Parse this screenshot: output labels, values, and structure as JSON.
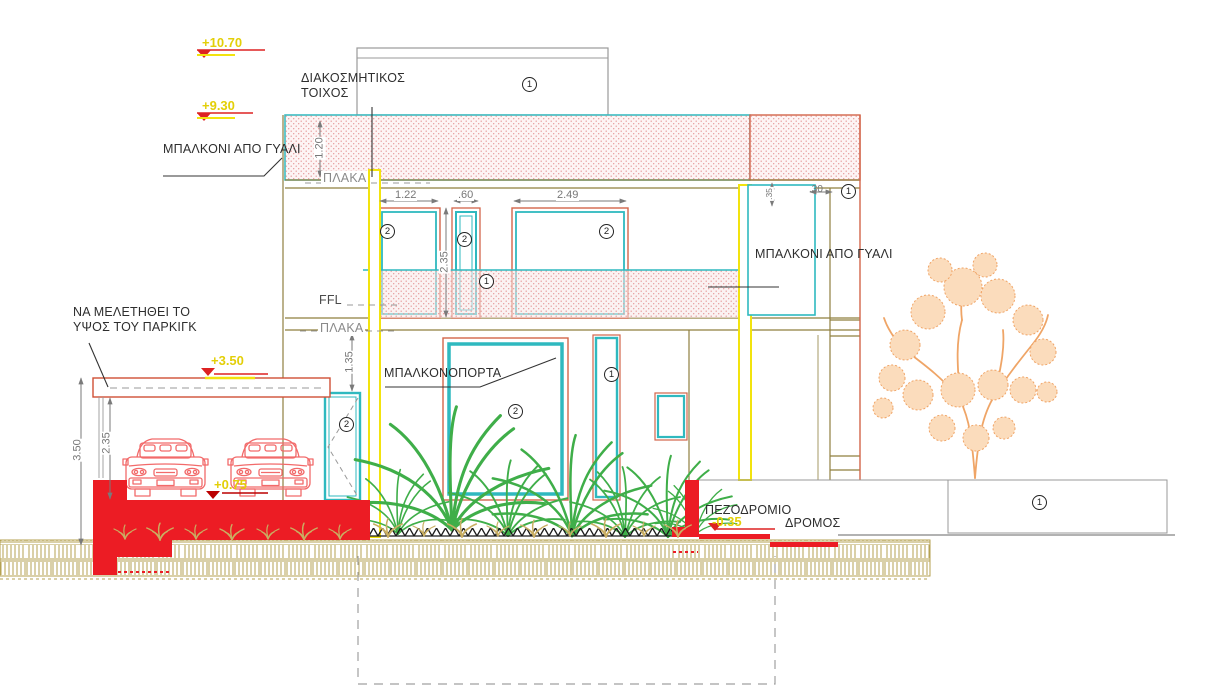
{
  "drawing": {
    "type": "building-front-elevation",
    "labels": {
      "decorative_wall": "ΔΙΑΚΟΣΜΗΤΙΚΟΣ\nΤΟΙΧΟΣ",
      "balcony_glass_left": "ΜΠΑΛΚΟΝΙ ΑΠΟ ΓΥΑΛΙ",
      "balcony_glass_right": "ΜΠΑΛΚΟΝΙ ΑΠΟ ΓΥΑΛΙ",
      "slab_upper": "ΠΛΑΚΑ",
      "ffl": "FFL",
      "slab_lower": "ΠΛΑΚΑ",
      "parking_note": "ΝΑ ΜΕΛΕΤΗΘΕΙ ΤΟ\nΥΨΟΣ ΤΟΥ ΠΑΡΚΙΓΚ",
      "balcony_door": "ΜΠΑΛΚΟΝΟΠΟΡΤΑ",
      "sidewalk": "ΠΕΖΟΔΡΟΜΙΟ",
      "road": "ΔΡΟΜΟΣ"
    },
    "elevation_markers": [
      {
        "text": "+10.70"
      },
      {
        "text": "+9.30"
      },
      {
        "text": "+3.50"
      },
      {
        "text": "+0.75"
      },
      {
        "text": "-0.35"
      }
    ],
    "dimensions": [
      {
        "text": "1.20"
      },
      {
        "text": "1.22"
      },
      {
        "text": ".60"
      },
      {
        "text": "2.49"
      },
      {
        "text": "2.35"
      },
      {
        "text": ".35"
      },
      {
        "text": ".30"
      },
      {
        "text": "1.35"
      },
      {
        "text": "3.50"
      },
      {
        "text": "2.35"
      }
    ],
    "keynotes": [
      {
        "n": "1"
      },
      {
        "n": "1"
      },
      {
        "n": "1"
      },
      {
        "n": "1"
      },
      {
        "n": "1"
      },
      {
        "n": "2"
      },
      {
        "n": "2"
      },
      {
        "n": "2"
      },
      {
        "n": "2"
      },
      {
        "n": "2"
      }
    ],
    "colors": {
      "red_fill": "#ec1c24",
      "yellow_column": "#f2e30e",
      "cyan_glass": "#2fb9bf",
      "orange_frame": "#d2654a",
      "pink_hatch": "#e59a9a",
      "wall_line": "#8f7f3f",
      "tree": "#f0a466",
      "plant": "#3fae49",
      "ground_hatch": "#b5a252",
      "elevation_text": "#e3cf08"
    }
  }
}
